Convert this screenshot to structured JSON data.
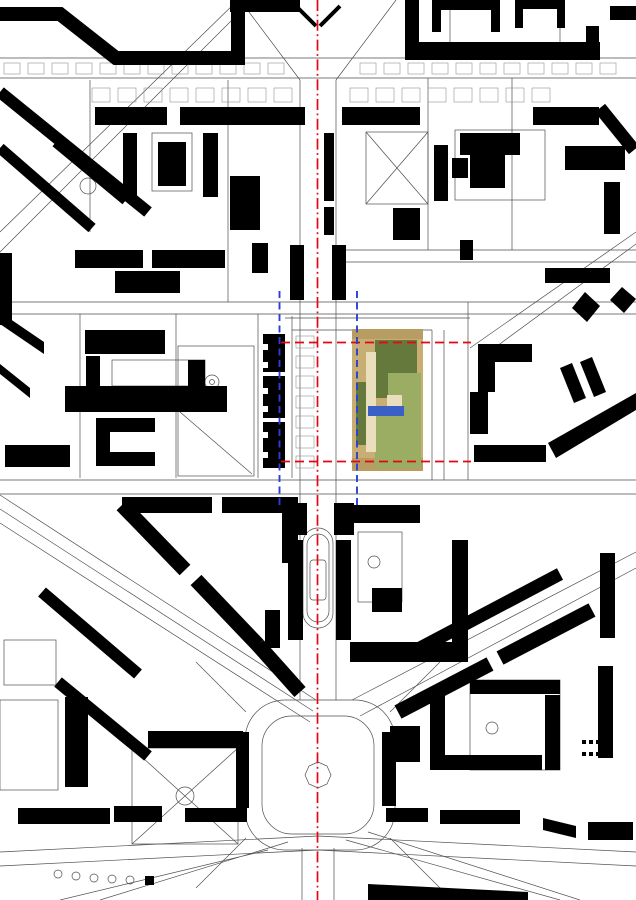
{
  "meta": {
    "description": "Figure-ground city site plan: black building footprints on white, central red dash-dot planning axis, red dashed site boundary lines, two blue dashed guide lines, and a colored aerial collage (lawn and paths) marking the project site north of a star-shaped plaza.",
    "canvas": {
      "width": 636,
      "height": 900
    }
  },
  "palette": {
    "background": "#ffffff",
    "building_black": "#000000",
    "street_line": "#4f4f4f",
    "minor_line": "#909090",
    "axis_red": "#e30613",
    "guide_blue": "#2b3fd8",
    "site_tan": "#c9ae74",
    "site_tan_dark": "#b89d63",
    "site_green_dark": "#66793c",
    "site_green_light": "#9aad63",
    "site_cream": "#e9dfbd",
    "site_blue": "#3a5fc6"
  },
  "overlays": {
    "central_axis": {
      "x": 317.5,
      "y1": 0,
      "y2": 900,
      "style": "red dash-dot vertical axis"
    },
    "site_boundary": {
      "x1": 281,
      "x2": 471,
      "y_top": 342.5,
      "y_bottom": 461.5,
      "style": "red dashed horizontals"
    },
    "guide_west": {
      "x": 279.5,
      "y1": 291,
      "y2": 508,
      "style": "blue dashed vertical"
    },
    "guide_east": {
      "x": 357,
      "y1": 291,
      "y2": 508,
      "style": "blue dashed vertical"
    },
    "aerial_patch": {
      "x": 352,
      "y": 329,
      "width": 71,
      "height": 142
    }
  }
}
